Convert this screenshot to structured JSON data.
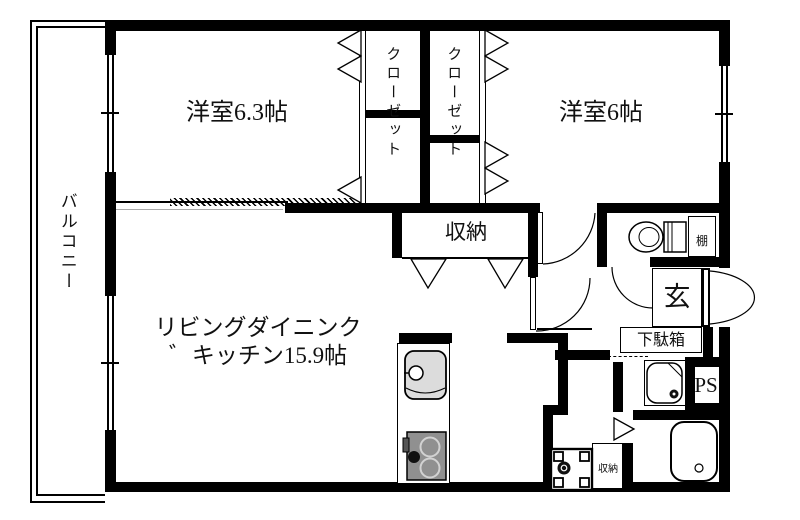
{
  "labels": {
    "balcony": "バルコニー",
    "bedroom1": "洋室6.3帖",
    "bedroom2": "洋室6帖",
    "closet1": "クローゼット",
    "closet2": "クローゼット",
    "storage": "収納",
    "ldk_line1": "リビングダイニンク",
    "ldk_line2": "゛キッチン15.9帖",
    "entrance": "玄",
    "shoe_cabinet": "下駄箱",
    "shelf": "棚",
    "pipe_space": "PS",
    "storage_small": "収納"
  },
  "colors": {
    "wall": "#000000",
    "floor": "#ffffff",
    "sink_fill": "#dcdcdc",
    "stove_fill": "#909090",
    "line": "#000000"
  }
}
